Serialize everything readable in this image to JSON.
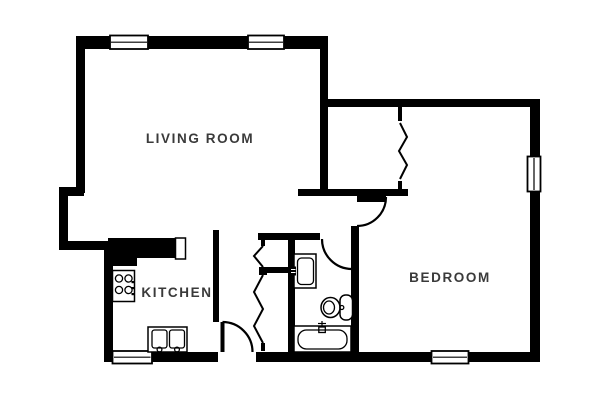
{
  "title": "Apartment floor plan",
  "colors": {
    "wall": "#000000",
    "label": "#3a3a3a",
    "background": "#ffffff"
  },
  "rooms": [
    {
      "id": "living-room",
      "label": "LIVING ROOM"
    },
    {
      "id": "kitchen",
      "label": "KITCHEN"
    },
    {
      "id": "bedroom",
      "label": "BEDROOM"
    }
  ],
  "fixtures": [
    "stove-4-burner",
    "kitchen-double-sink",
    "bathroom-vanity-sink",
    "toilet",
    "bathtub"
  ],
  "openings": {
    "windows": 5,
    "swing_doors": 3,
    "accordion_doors": 2
  }
}
